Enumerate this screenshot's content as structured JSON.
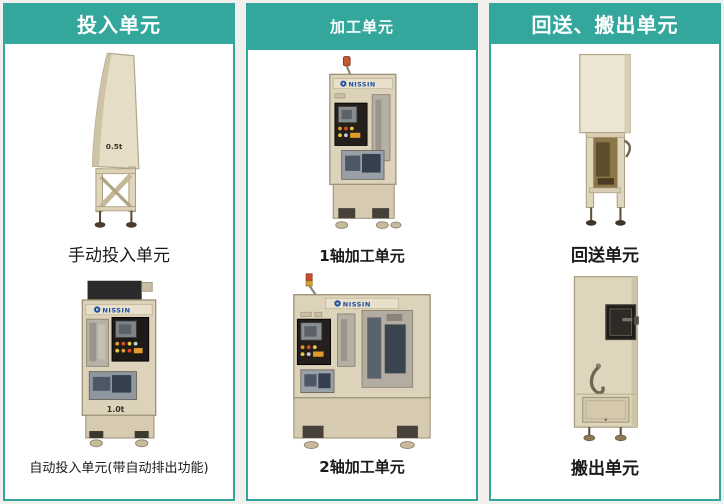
{
  "page": {
    "accent_color": "#34a79d",
    "panel_color": "#ffffff",
    "background_color": "#f1f0ed"
  },
  "columns": [
    {
      "header": "投入单元",
      "items": [
        {
          "caption": "手动投入单元",
          "badge": "0.5t"
        },
        {
          "caption": "自动投入单元(带自动排出功能)",
          "badge": "1.0t",
          "brand": "NISSIN"
        }
      ]
    },
    {
      "header": "加工单元",
      "items": [
        {
          "caption": "1轴加工单元",
          "badge": "1.0t",
          "brand": "NISSIN"
        },
        {
          "caption": "2轴加工单元",
          "badge": "2.5t",
          "brand": "NISSIN"
        }
      ]
    },
    {
      "header": "回送、搬出单元",
      "items": [
        {
          "caption": "回送单元"
        },
        {
          "caption": "搬出单元"
        }
      ]
    }
  ]
}
